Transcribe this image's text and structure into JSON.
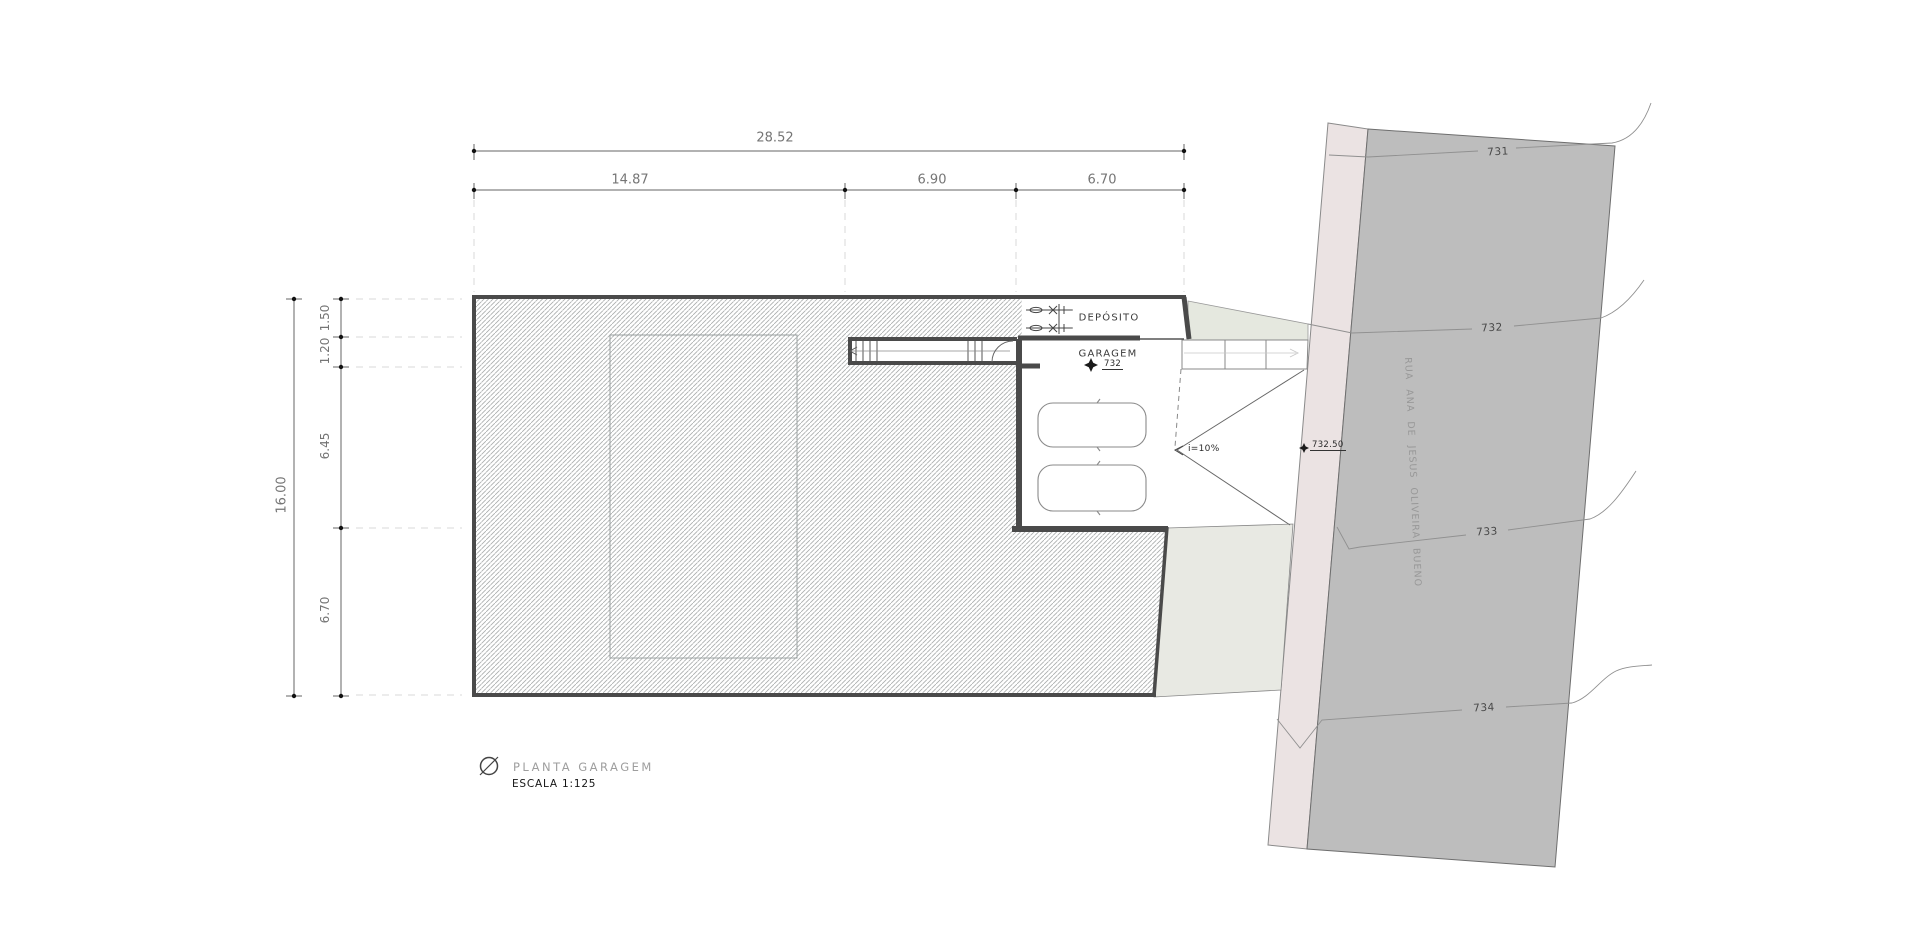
{
  "plan": {
    "title": {
      "icon": "circle-slash-icon",
      "label": "PLANTA GARAGEM",
      "scale": "ESCALA 1:125"
    },
    "rooms": {
      "deposito": {
        "label": "DEPÓSITO"
      },
      "garagem": {
        "label": "GARAGEM",
        "level": "732"
      }
    },
    "ramp": {
      "slope": "i=10%",
      "street_level": "732.50"
    },
    "dimensions": {
      "top": {
        "total": "28.52",
        "segments": [
          "14.87",
          "6.90",
          "6.70"
        ]
      },
      "left": {
        "total": "16.00",
        "segments": [
          "1.50",
          "1.20",
          "6.45",
          "6.70"
        ]
      }
    },
    "street": {
      "name": "RUA  ANA  DE  JESUS  OLIVEIRA  BUENO",
      "contour_labels": [
        "731",
        "732",
        "733",
        "734"
      ]
    },
    "colors": {
      "road": "#bdbdbd",
      "curb_strip": "#ebe3e3",
      "grass_verge": "#e5e8df",
      "sidewalk": "#e8e9e3",
      "hatch_line": "#a9acac",
      "wall": "#4a4a4a"
    }
  }
}
